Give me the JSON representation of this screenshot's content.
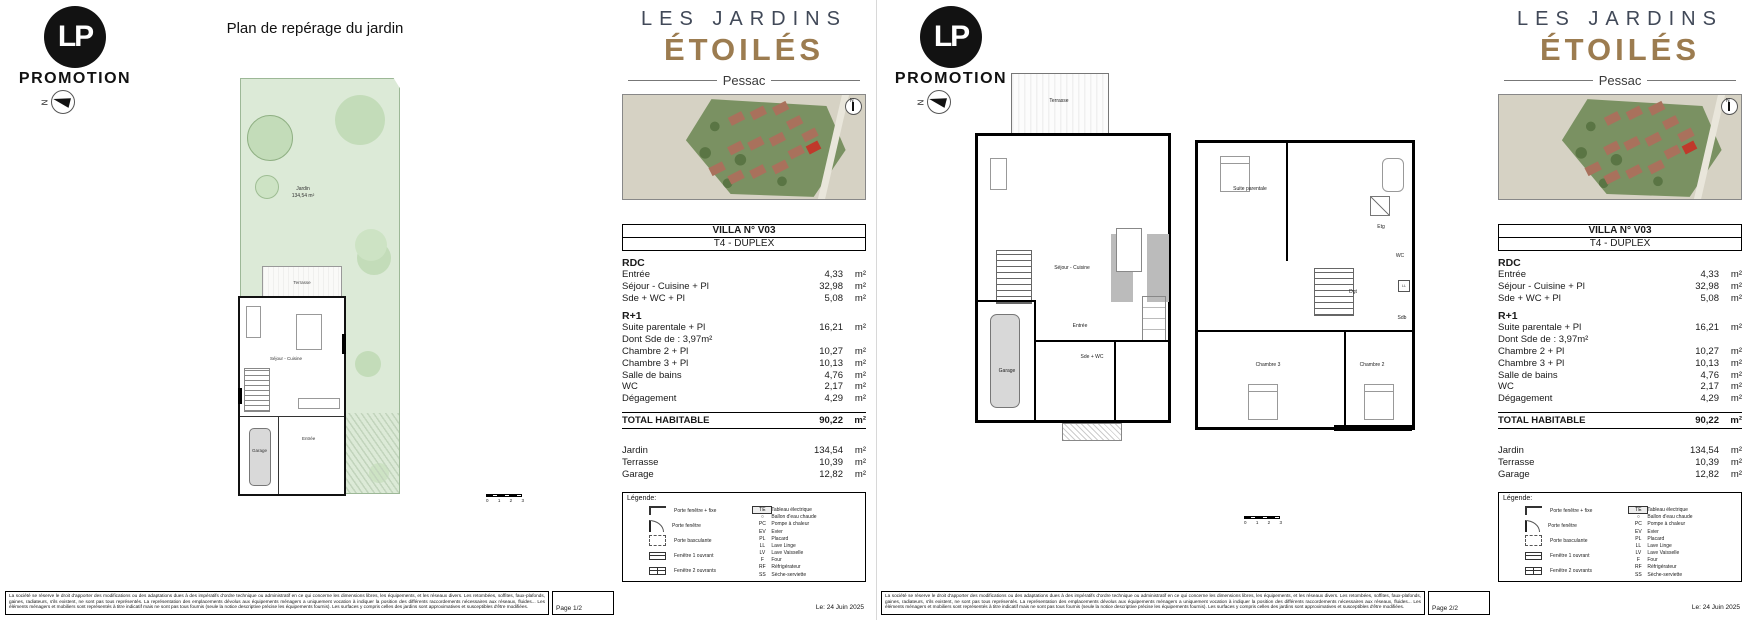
{
  "brand": {
    "initials": "LP",
    "name": "PROMOTION"
  },
  "project": {
    "line1": "LES JARDINS",
    "line2": "ÉTOILÉS",
    "city": "Pessac"
  },
  "compass_n": "N",
  "page1": {
    "title": "Plan de repérage du jardin",
    "page_label": "Page 1/2",
    "garden": {
      "jardin": "Jardin",
      "jardin_area": "134,54 m²",
      "terrasse": "Terrasse",
      "sejour": "Séjour - Cuisine",
      "entree": "Entrée",
      "garage": "Garage"
    }
  },
  "page2": {
    "page_label": "Page 2/2",
    "rdc": {
      "terrasse": "Terrasse",
      "sejour": "Séjour - Cuisine",
      "entree": "Entrée",
      "sde_wc": "Sde + WC",
      "garage": "Garage"
    },
    "r1": {
      "suite": "Suite parentale",
      "etg": "Etg",
      "wc": "WC",
      "dgt": "Dgt",
      "ll": "LL",
      "sdb": "Sdb",
      "ch3": "Chambre 3",
      "ch2": "Chambre 2"
    }
  },
  "villa": {
    "number": "VILLA N° V03",
    "type": "T4 - DUPLEX",
    "rdc_title": "RDC",
    "rdc_rows": [
      {
        "label": "Entrée",
        "value": "4,33",
        "unit": "m²"
      },
      {
        "label": "Séjour - Cuisine + Pl",
        "value": "32,98",
        "unit": "m²"
      },
      {
        "label": "Sde + WC + Pl",
        "value": "5,08",
        "unit": "m²"
      }
    ],
    "r1_title": "R+1",
    "r1_rows": [
      {
        "label": "Suite parentale + Pl",
        "value": "16,21",
        "unit": "m²"
      },
      {
        "label": "Dont Sde de : 3,97m²",
        "value": "",
        "unit": ""
      },
      {
        "label": "Chambre 2 + Pl",
        "value": "10,27",
        "unit": "m²"
      },
      {
        "label": "Chambre 3 + Pl",
        "value": "10,13",
        "unit": "m²"
      },
      {
        "label": "Salle de bains",
        "value": "4,76",
        "unit": "m²"
      },
      {
        "label": "WC",
        "value": "2,17",
        "unit": "m²"
      },
      {
        "label": "Dégagement",
        "value": "4,29",
        "unit": "m²"
      }
    ],
    "total_label": "TOTAL HABITABLE",
    "total_value": "90,22",
    "total_unit": "m²",
    "extras": [
      {
        "label": "Jardin",
        "value": "134,54",
        "unit": "m²"
      },
      {
        "label": "Terrasse",
        "value": "10,39",
        "unit": "m²"
      },
      {
        "label": "Garage",
        "value": "12,82",
        "unit": "m²"
      }
    ]
  },
  "legend": {
    "title": "Légende:",
    "doors": [
      "Porte fenêtre + fixe",
      "Porte fenêtre",
      "Porte basculante",
      "Fenêtre 1 ouvrant",
      "Fenêtre 2 ouvrants"
    ],
    "equipment": [
      {
        "code": "TE",
        "label": "Tableau électrique"
      },
      {
        "code": "○",
        "label": "Ballon d'eau chaude"
      },
      {
        "code": "PC",
        "label": "Pompe à chaleur"
      },
      {
        "code": "EV",
        "label": "Evier"
      },
      {
        "code": "PL",
        "label": "Placard"
      },
      {
        "code": "LL",
        "label": "Lave Linge"
      },
      {
        "code": "LV",
        "label": "Lave Vaisselle"
      },
      {
        "code": "F",
        "label": "Four"
      },
      {
        "code": "RF",
        "label": "Réfrigérateur"
      },
      {
        "code": "SS",
        "label": "Sèche-serviette"
      }
    ]
  },
  "footer": {
    "date": "Le: 24 Juin 2025",
    "disclaimer": "La société se réserve le droit d'apporter des modifications ou des adaptations dues à des impératifs d'ordre technique ou administratif en ce qui concerne les dimensions libres, les équipements, et les réseaux divers. Les retombées, soffites, faux-plafonds, gaines, radiateurs, s'ils existent, ne sont pas tous représentés. La représentation des emplacements dévolus aux équipements ménagers a uniquement vocation à indiquer la position des différents raccordements nécessaires aux réseaux, fluides... Les éléments ménagers et mobiliers sont représentés à titre indicatif mais ne sont pas tous fournis (seule la notice descriptive précise les équipements fournis). Les surfaces y compris celles des jardins sont approximatives et susceptibles d'être modifiées."
  },
  "scalebar": {
    "t0": "0",
    "t1": "1",
    "t2": "2",
    "t3": "3"
  },
  "colors": {
    "accent_bronze": "#9c7c50",
    "title_dark": "#414958",
    "garden_green": "#dcead7",
    "tree_green": "#c3dcb9",
    "aerial_green": "#7a9162",
    "building_brown": "#a9715c",
    "highlight_red": "#c0392b"
  }
}
